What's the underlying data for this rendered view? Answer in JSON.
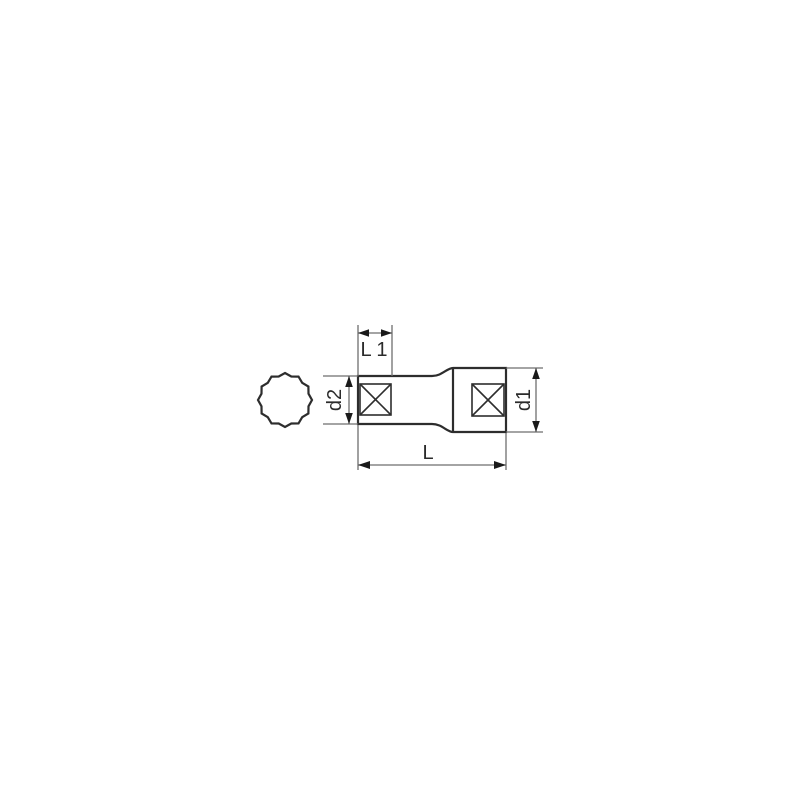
{
  "drawing": {
    "kind": "socket-dimension-diagram",
    "labels": {
      "l1": "L 1",
      "d2": "d2",
      "d1": "d1",
      "l": "L"
    },
    "shapes": {
      "profile": "twelve-point-socket-profile",
      "side_view": "deep-socket-side-view"
    },
    "colors": {
      "background": "#ffffff",
      "outline": "#2d2d2d",
      "dimension_line": "#6e6e6e",
      "arrowhead": "#1a1a1a",
      "label_text": "#2b2b2b"
    }
  }
}
